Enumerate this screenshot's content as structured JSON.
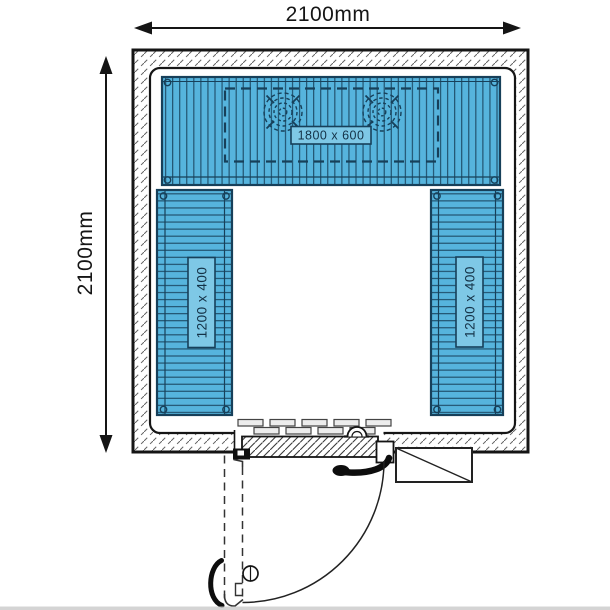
{
  "dimensions": {
    "top_label": "2100mm",
    "left_label": "2100mm"
  },
  "shelf_labels": {
    "top": "1800 x 600",
    "left": "1200 x 400",
    "right": "1200 x 400"
  },
  "colors": {
    "shelf_fill": "#56b4dd",
    "shelf_line": "#17405a",
    "label_box_fill": "#7ec8e6",
    "label_text": "#143247",
    "ink": "#1a1a1a",
    "wall_hatch": "#636363"
  }
}
